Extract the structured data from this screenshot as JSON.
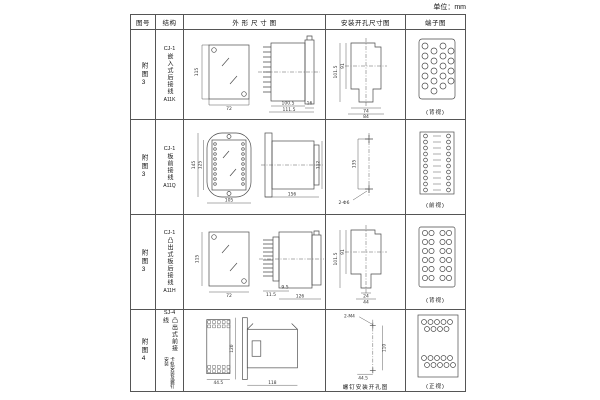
{
  "unit_label": "单位：mm",
  "table": {
    "headers": [
      "图号",
      "结构",
      "外 形 尺 寸 图",
      "安装开孔尺寸图",
      "端子图"
    ],
    "rows": [
      {
        "fig_no": "附图3",
        "model": "CJ-1",
        "structure": "嵌入式后接线",
        "code": "A11K",
        "outline": {
          "h": "115",
          "w": "72",
          "d1": "100.5",
          "d2": "111.5",
          "d3": "16"
        },
        "mounting": {
          "v1": "101.5",
          "v2": "91",
          "h1": "74",
          "h2": "84"
        },
        "terminal": {
          "caption": "(背视)"
        }
      },
      {
        "fig_no": "附图3",
        "model": "CJ-1",
        "structure": "板前接线",
        "code": "A11Q",
        "outline": {
          "h": "145",
          "h2": "125",
          "w": "105",
          "l": "156",
          "sh": "112"
        },
        "mounting": {
          "v1": "135",
          "holes": "2-Φ6"
        },
        "terminal": {
          "caption": "(前视)"
        }
      },
      {
        "fig_no": "附图3",
        "model": "CJ-1",
        "structure": "凸出式板后接线",
        "code": "A11H",
        "outline": {
          "h": "115",
          "w": "72",
          "d1": "11.5",
          "d2": "9.5",
          "l": "126"
        },
        "mounting": {
          "v1": "101.5",
          "v2": "91",
          "h1": "24",
          "h2": "44"
        },
        "terminal": {
          "caption": "(背视)"
        }
      },
      {
        "fig_no": "附图4",
        "model": "SJ-4",
        "structure": "凸出式前接线",
        "note": "卡轨安装及螺钉安装",
        "outline": {
          "w": "44.5",
          "h": "120",
          "l": "118"
        },
        "mounting": {
          "holes": "2-M4",
          "v1": "110",
          "h1": "44.5",
          "caption": "螺钉安装开孔图"
        },
        "terminal": {
          "caption": "(正视)"
        }
      }
    ]
  }
}
